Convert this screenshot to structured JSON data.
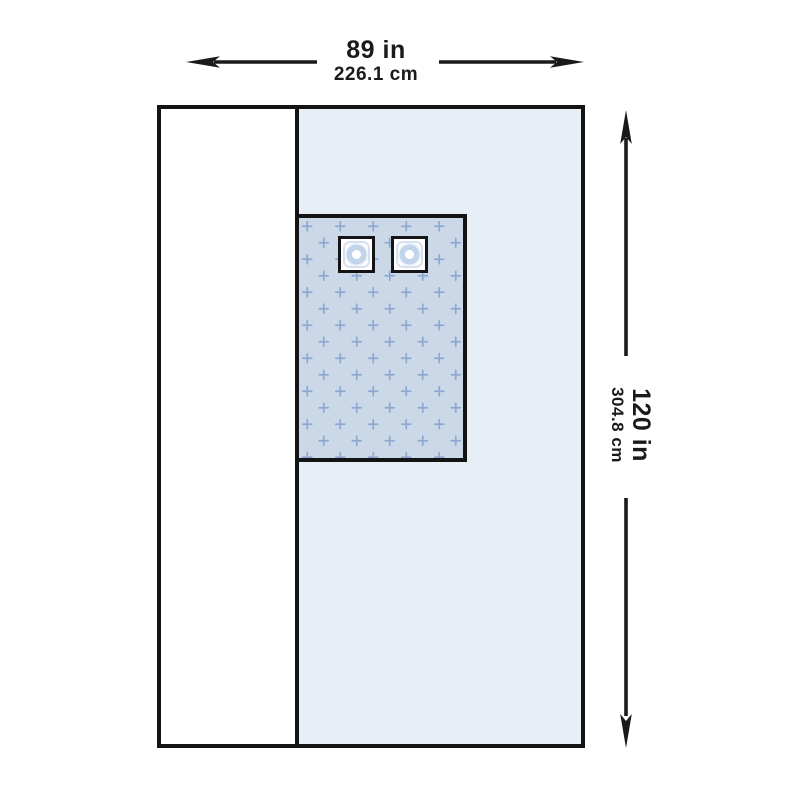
{
  "dimensions": {
    "width": {
      "in": "89 in",
      "cm": "226.1 cm"
    },
    "height": {
      "in": "120 in",
      "cm": "304.8 cm"
    }
  },
  "drape": {
    "panels": {
      "side_panel": "plain white fold-back panel",
      "main_panel": "light blue drape body",
      "reinforcement_panel": "absorbent reinforcement zone with cross pattern",
      "tube_holders": [
        "tube-holder-left",
        "tube-holder-right"
      ]
    }
  },
  "icons": {
    "width_arrow_left": "dimension-arrow-left",
    "width_arrow_right": "dimension-arrow-right",
    "height_arrow_up": "dimension-arrow-up",
    "height_arrow_down": "dimension-arrow-down"
  },
  "colors": {
    "outline": "#141414",
    "arrow": "#1a1a1a",
    "side_panel": "#ffffff",
    "main_panel": "#e8eef5",
    "reinforcement_panel": "#cbd8e8",
    "pattern_cross": "#7e9ccd",
    "port_ring": "#c2d4ea"
  }
}
